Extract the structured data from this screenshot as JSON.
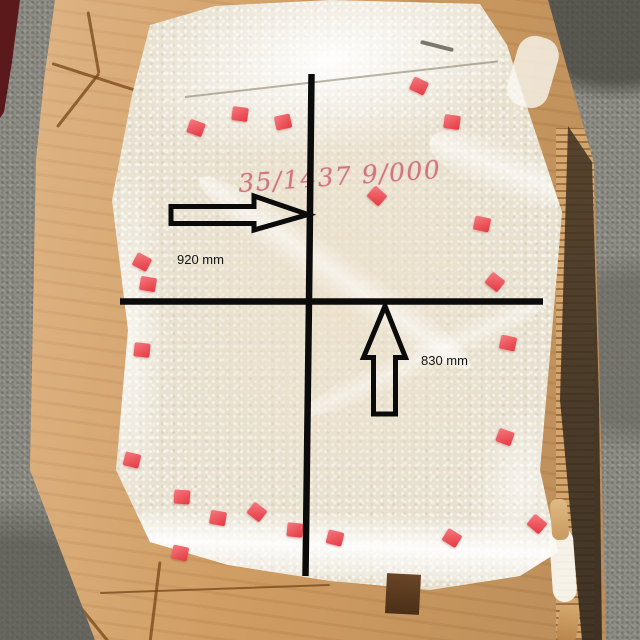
{
  "scene": {
    "alt": "Photo of a glass panel wrapped in bubble wrap inside an open cardboard box on a concrete warehouse floor, annotated with measurement lines"
  },
  "annotations": {
    "width_label": "920 mm",
    "height_label": "830 mm",
    "width_mm": 920,
    "height_mm": 830,
    "handwritten_code": "35/1437 9/000",
    "line_color": "#0b0b0b",
    "label_color": "#131313",
    "handwriting_color": "#ce6073"
  },
  "palette": {
    "concrete_floor": "#8f8e86",
    "cardboard": "#d8a367",
    "cardboard_shadow": "#3a2d1f",
    "bubble_wrap": "#e8e1d0",
    "clip_red": "#e8434b",
    "maroon_corner": "#501617"
  },
  "clips": [
    {
      "x": 196,
      "y": 128,
      "r": 20
    },
    {
      "x": 240,
      "y": 114,
      "r": 8
    },
    {
      "x": 283,
      "y": 122,
      "r": -12
    },
    {
      "x": 419,
      "y": 86,
      "r": 25
    },
    {
      "x": 452,
      "y": 122,
      "r": 8
    },
    {
      "x": 377,
      "y": 196,
      "r": 42
    },
    {
      "x": 142,
      "y": 262,
      "r": 28
    },
    {
      "x": 148,
      "y": 284,
      "r": 10
    },
    {
      "x": 142,
      "y": 350,
      "r": 6
    },
    {
      "x": 132,
      "y": 460,
      "r": 14
    },
    {
      "x": 182,
      "y": 497,
      "r": 4
    },
    {
      "x": 218,
      "y": 518,
      "r": 10
    },
    {
      "x": 257,
      "y": 512,
      "r": 38
    },
    {
      "x": 295,
      "y": 530,
      "r": 6
    },
    {
      "x": 180,
      "y": 553,
      "r": 12
    },
    {
      "x": 335,
      "y": 538,
      "r": 14
    },
    {
      "x": 452,
      "y": 538,
      "r": 32
    },
    {
      "x": 537,
      "y": 524,
      "r": 40
    },
    {
      "x": 482,
      "y": 224,
      "r": 12
    },
    {
      "x": 495,
      "y": 282,
      "r": 38
    },
    {
      "x": 508,
      "y": 343,
      "r": 12
    },
    {
      "x": 505,
      "y": 437,
      "r": 20
    }
  ]
}
